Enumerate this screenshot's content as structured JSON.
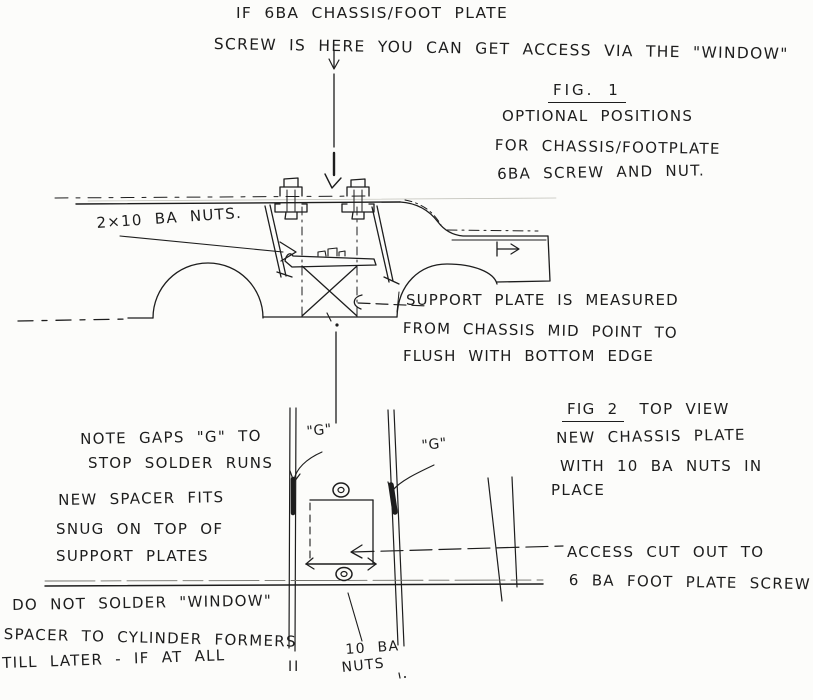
{
  "ink_color": "#1d1d1d",
  "paper_color": "#fcfcfa",
  "top_note": {
    "line1": "IF 6BA CHASSIS/FOOT PLATE",
    "line2": "SCREW IS HERE YOU CAN GET ACCESS VIA THE \"WINDOW\""
  },
  "fig1": {
    "title": "FIG. 1",
    "caption": [
      "OPTIONAL POSITIONS",
      "FOR CHASSIS/FOOTPLATE",
      "6BA SCREW AND NUT."
    ],
    "nuts_label": "2×10 BA NUTS.",
    "support_note": [
      "SUPPORT PLATE IS MEASURED",
      "FROM CHASSIS MID POINT TO",
      "FLUSH WITH BOTTOM EDGE"
    ]
  },
  "fig2": {
    "title": "FIG 2",
    "title_suffix": "TOP VIEW",
    "caption": [
      "NEW CHASSIS PLATE",
      "WITH 10 BA NUTS IN",
      "PLACE"
    ],
    "gaps_note": [
      "NOTE GAPS \"G\" TO",
      "STOP SOLDER RUNS"
    ],
    "spacer_note": [
      "NEW SPACER FITS",
      "SNUG ON TOP OF",
      "SUPPORT PLATES"
    ],
    "warning_note": [
      "DO NOT SOLDER \"WINDOW\"",
      "SPACER TO CYLINDER FORMERS",
      "TILL LATER - IF AT ALL"
    ],
    "access_note": [
      "ACCESS CUT OUT TO",
      "6 BA FOOT PLATE SCREW"
    ],
    "nuts_label": [
      "10 BA",
      "NUTS"
    ],
    "gap_label_left": "\"G\"",
    "gap_label_right": "\"G\"",
    "rail_end_mark": "II"
  }
}
